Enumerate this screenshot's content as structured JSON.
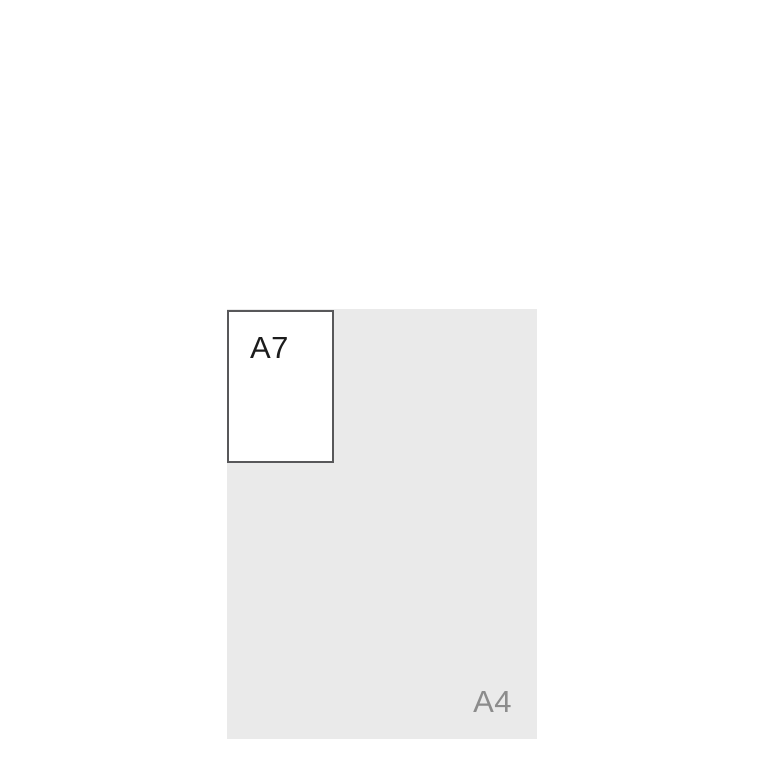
{
  "diagram": {
    "name": "paper-size-comparison",
    "background_color": "#ffffff"
  },
  "a4": {
    "label": "A4",
    "fill_color": "#eaeaea",
    "label_color": "#8c8c8c"
  },
  "a7": {
    "label": "A7",
    "fill_color": "#ffffff",
    "border_color": "#58585a",
    "label_color": "#1c1c1c"
  }
}
